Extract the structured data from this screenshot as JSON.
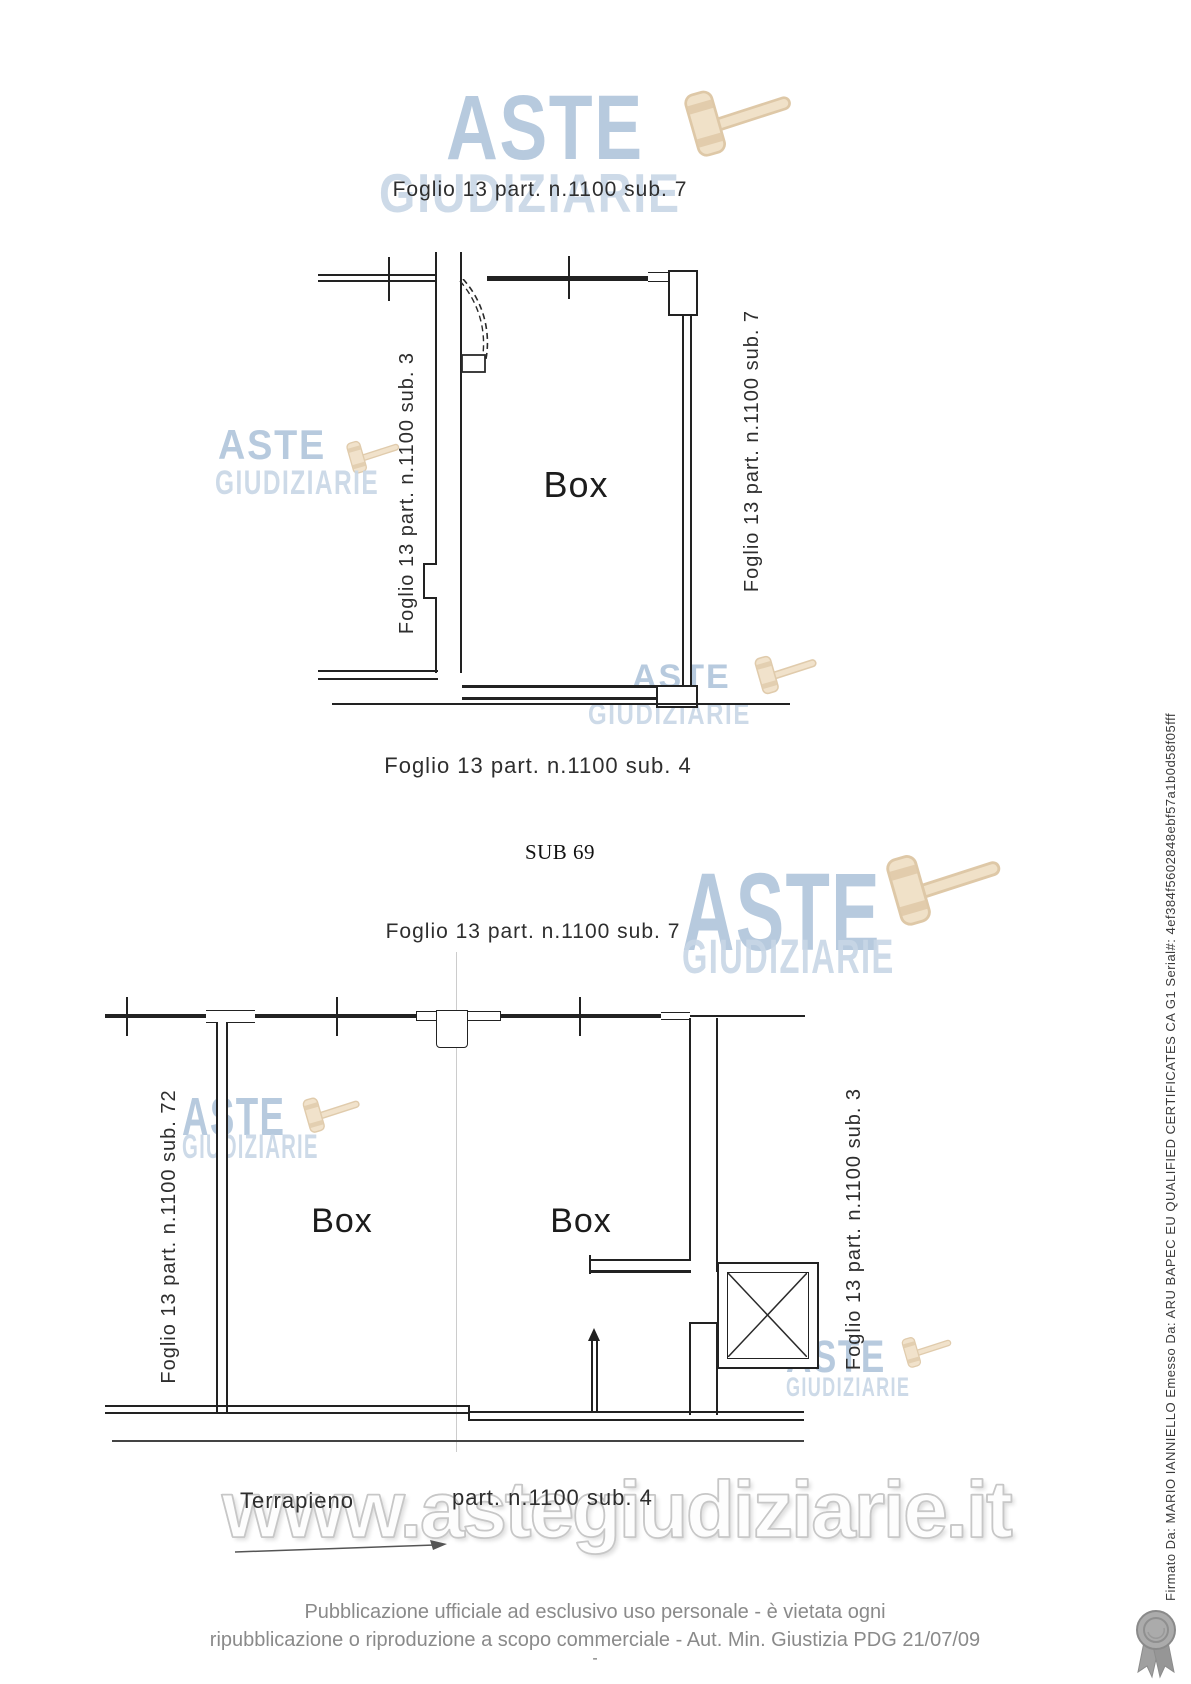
{
  "document": {
    "header": {
      "title": "Foglio 13 part. n.1100 sub. 7"
    },
    "plan1": {
      "side_left": "Foglio 13 part. n.1100 sub. 3",
      "side_right": "Foglio 13 part. n.1100 sub. 7",
      "room": "Box",
      "caption": "Foglio 13 part. n.1100 sub. 4"
    },
    "section_heading": "SUB 69",
    "plan2": {
      "title": "Foglio 13 part. n.1100 sub. 7",
      "side_left": "Foglio 13 part. n.1100 sub. 72",
      "side_right": "Foglio 13 part. n.1100 sub. 3",
      "room_left": "Box",
      "room_right": "Box",
      "terrain": "Terrapieno",
      "parcel": "part. n.1100 sub. 4"
    },
    "watermarks": {
      "brand_top": "ASTE",
      "brand_bottom": "GIUDIZIARIE",
      "url": "www.astegiudiziarie.it"
    },
    "footer": {
      "line1": "Pubblicazione ufficiale ad esclusivo uso personale - è vietata ogni",
      "line2": "ripubblicazione o riproduzione a scopo commerciale - Aut. Min. Giustizia PDG 21/07/09",
      "dash": "-"
    },
    "signature": "Firmato Da: MARIO IANNIELLO Emesso Da: ARU BAPEC EU QUALIFIED CERTIFICATES CA G1 Serial#: 4ef384f5602848ebf57a1b0d58f05fff",
    "colors": {
      "watermark_blue": "#b0c5db",
      "watermark_blue_light": "#c8d7e6",
      "gavel_tan": "#eedcbf",
      "plan_line": "#222222",
      "footer_gray": "#8a8a8a",
      "url_outline": "#c7c7c7"
    }
  }
}
